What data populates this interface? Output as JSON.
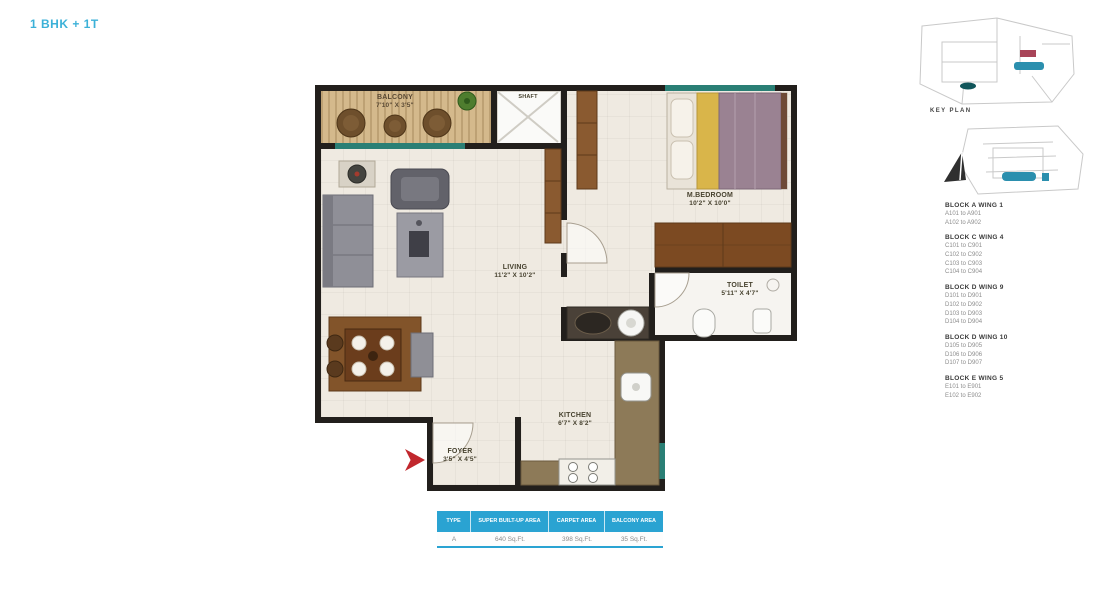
{
  "page": {
    "title": "1 BHK + 1T"
  },
  "plan": {
    "rooms": {
      "balcony": {
        "name": "BALCONY",
        "dims": "7'10\" X 3'5\""
      },
      "shaft": {
        "name": "SHAFT"
      },
      "bedroom": {
        "name": "M.BEDROOM",
        "dims": "10'2\" X 10'0\""
      },
      "living": {
        "name": "LIVING",
        "dims": "11'2\" X 10'2\""
      },
      "toilet": {
        "name": "TOILET",
        "dims": "5'11\" X 4'7\""
      },
      "kitchen": {
        "name": "KITCHEN",
        "dims": "6'7\" X 8'2\""
      },
      "foyer": {
        "name": "FOYER",
        "dims": "3'5\" X 4'5\""
      }
    }
  },
  "area_table": {
    "headers": [
      "TYPE",
      "SUPER BUILT-UP AREA",
      "CARPET AREA",
      "BALCONY AREA"
    ],
    "row": [
      "A",
      "640 Sq.Ft.",
      "398 Sq.Ft.",
      "35 Sq.Ft."
    ]
  },
  "key_plan": {
    "label": "KEY PLAN",
    "blocks": [
      {
        "name": "BLOCK A WING 1",
        "units": [
          "A101 to A901",
          "A102 to A902"
        ]
      },
      {
        "name": "BLOCK C WING 4",
        "units": [
          "C101 to C901",
          "C102 to C902",
          "C103 to C903",
          "C104 to C904"
        ]
      },
      {
        "name": "BLOCK D WING 9",
        "units": [
          "D101 to D901",
          "D102 to D902",
          "D103 to D903",
          "D104 to D904"
        ]
      },
      {
        "name": "BLOCK D WING 10",
        "units": [
          "D105 to D905",
          "D106 to D906",
          "D107 to D907"
        ]
      },
      {
        "name": "BLOCK E WING 5",
        "units": [
          "E101 to E901",
          "E102 to E902"
        ]
      }
    ]
  },
  "colors": {
    "accent_blue": "#3cb1d8",
    "table_header": "#2aa3d2",
    "wall": "#221f1c",
    "window_teal": "#2a7f75",
    "entry_arrow": "#c1272d",
    "balcony_tan": "#d4b98c",
    "wood_brown": "#7c4a22"
  }
}
